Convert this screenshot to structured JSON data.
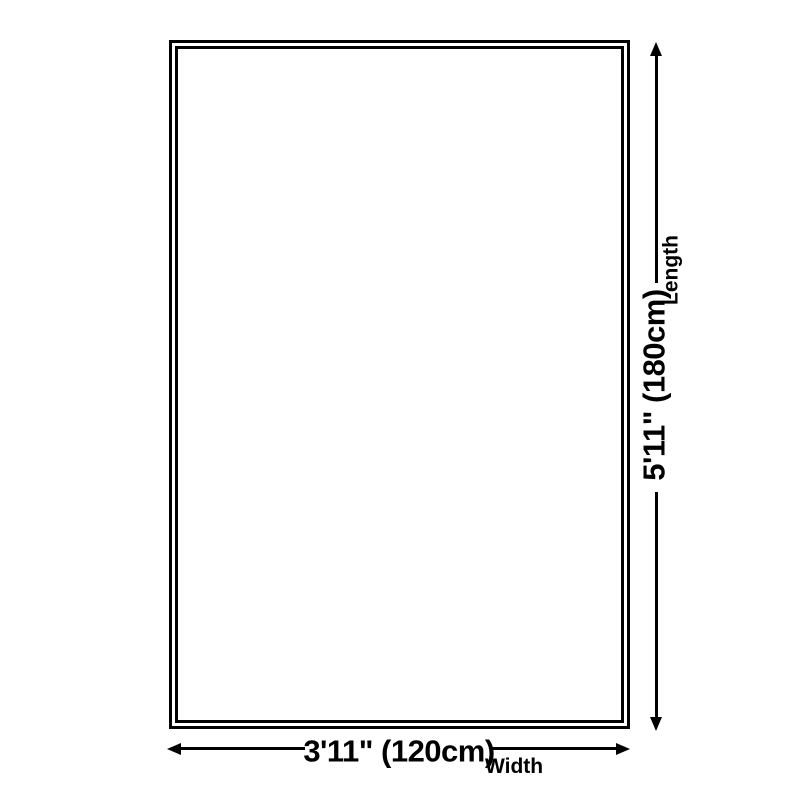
{
  "diagram": {
    "title": "product-size-diagram",
    "length": {
      "value": "5'11\" (180cm)",
      "label": "Length"
    },
    "width": {
      "value": "3'11\" (120cm)",
      "label": "Width"
    },
    "colors": {
      "line": "#000000",
      "background": "#ffffff"
    }
  }
}
